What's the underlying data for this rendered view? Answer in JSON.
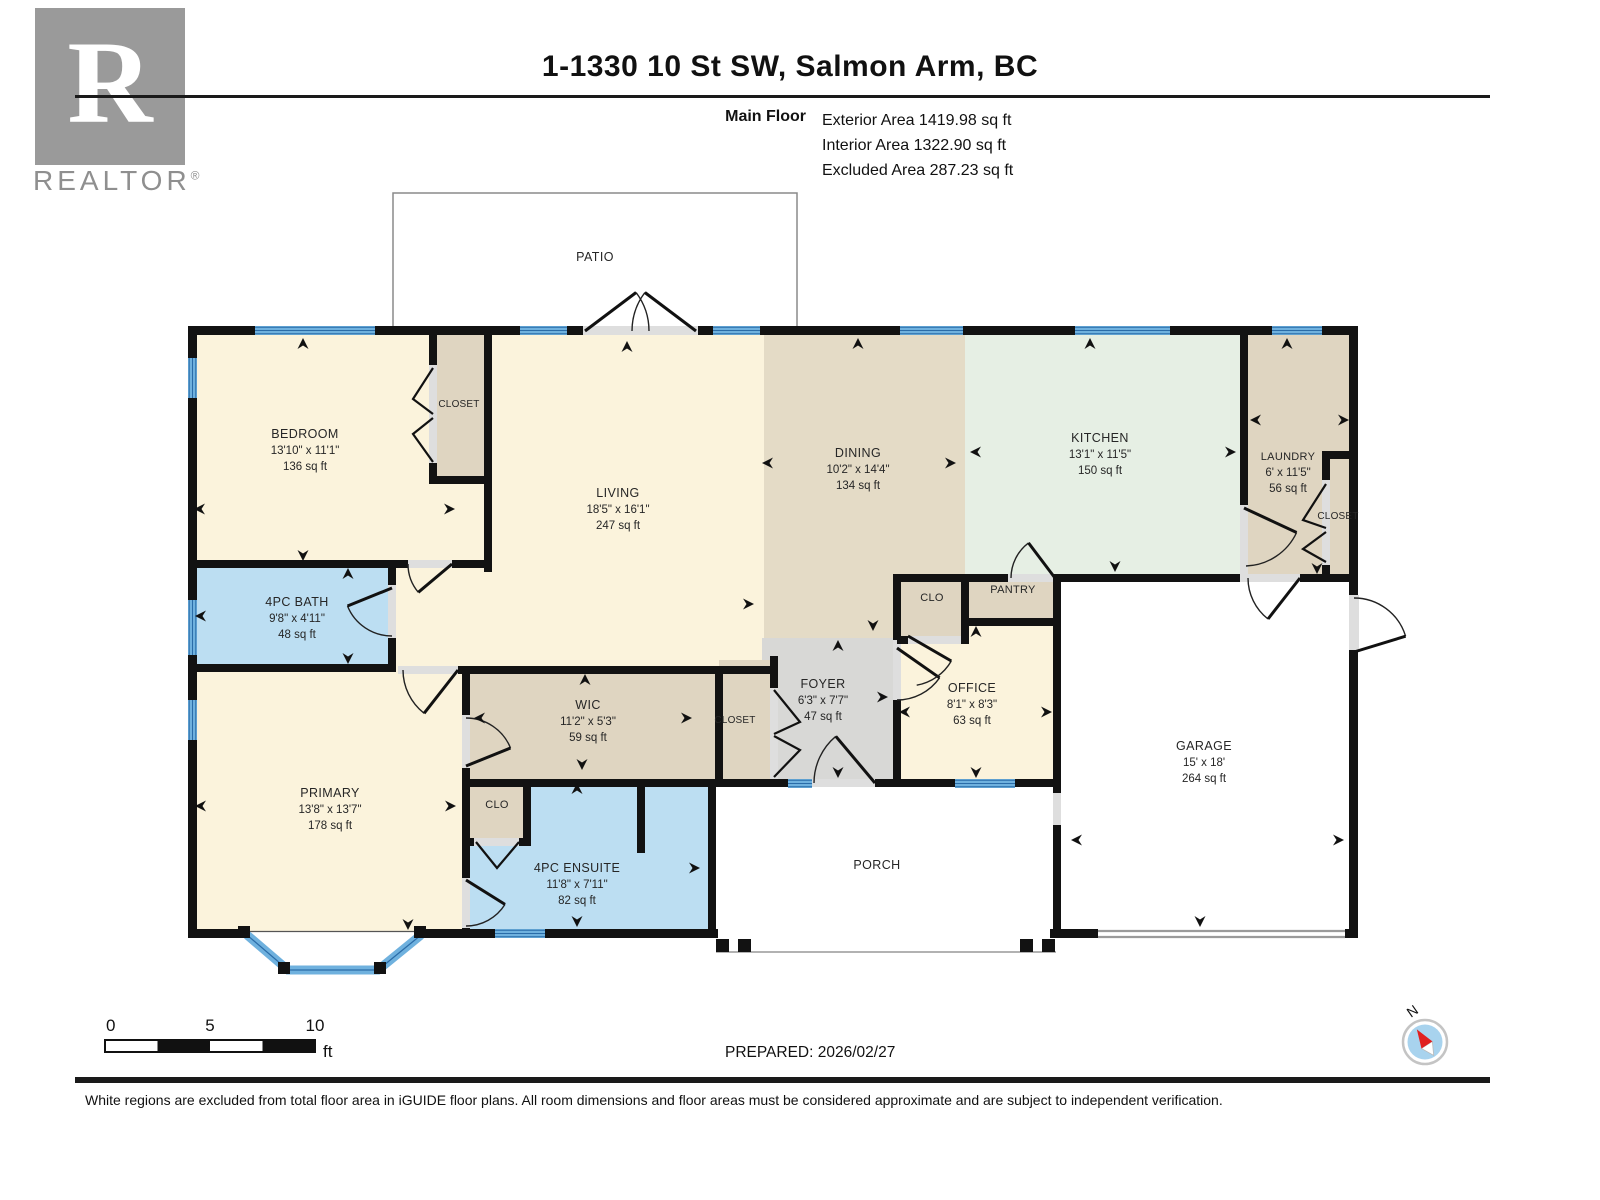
{
  "header": {
    "logo_letter": "R",
    "logo_text": "REALTOR",
    "logo_reg": "®",
    "title": "1-1330 10 St SW, Salmon Arm, BC",
    "floor_label": "Main Floor",
    "stats": [
      "Exterior Area 1419.98 sq ft",
      "Interior Area 1322.90 sq ft",
      "Excluded Area 287.23 sq ft"
    ]
  },
  "rooms": {
    "patio": {
      "name": "PATIO"
    },
    "bedroom": {
      "name": "BEDROOM",
      "dims": "13'10\" x 11'1\"",
      "area": "136 sq ft"
    },
    "closet_bedroom": {
      "name": "CLOSET"
    },
    "living": {
      "name": "LIVING",
      "dims": "18'5\" x 16'1\"",
      "area": "247 sq ft"
    },
    "dining": {
      "name": "DINING",
      "dims": "10'2\" x 14'4\"",
      "area": "134 sq ft"
    },
    "kitchen": {
      "name": "KITCHEN",
      "dims": "13'1\" x 11'5\"",
      "area": "150 sq ft"
    },
    "laundry": {
      "name": "LAUNDRY",
      "dims": "6' x 11'5\"",
      "area": "56 sq ft"
    },
    "closet_laundry": {
      "name": "CLOSET"
    },
    "bath": {
      "name": "4PC BATH",
      "dims": "9'8\" x 4'11\"",
      "area": "48 sq ft"
    },
    "primary": {
      "name": "PRIMARY",
      "dims": "13'8\" x 13'7\"",
      "area": "178 sq ft"
    },
    "wic": {
      "name": "WIC",
      "dims": "11'2\" x 5'3\"",
      "area": "59 sq ft"
    },
    "closet_hall": {
      "name": "CLOSET"
    },
    "foyer": {
      "name": "FOYER",
      "dims": "6'3\" x 7'7\"",
      "area": "47 sq ft"
    },
    "clo_office": {
      "name": "CLO"
    },
    "pantry": {
      "name": "PANTRY"
    },
    "office": {
      "name": "OFFICE",
      "dims": "8'1\" x 8'3\"",
      "area": "63 sq ft"
    },
    "garage": {
      "name": "GARAGE",
      "dims": "15' x 18'",
      "area": "264 sq ft"
    },
    "clo_primary": {
      "name": "CLO"
    },
    "ensuite": {
      "name": "4PC ENSUITE",
      "dims": "11'8\" x 7'11\"",
      "area": "82 sq ft"
    },
    "porch": {
      "name": "PORCH"
    }
  },
  "scale_bar": {
    "ticks": [
      "0",
      "5",
      "10"
    ],
    "unit": "ft"
  },
  "footer": {
    "prepared": "PREPARED: 2026/02/27",
    "compass_label": "N",
    "disclaimer": "White regions are excluded from total floor area in iGUIDE floor plans. All room dimensions and floor areas must be considered approximate and are subject to independent verification."
  },
  "colors": {
    "room_cream": "#FBF3DC",
    "room_tan": "#DFD5C1",
    "room_dining": "#E4DBC6",
    "room_kitchen": "#E6EFE4",
    "room_blue": "#BCDEF2",
    "room_gray": "#D8D8D6",
    "window_blue": "#6FB1DE",
    "window_line": "#2A6CA8",
    "door_gray": "#DEDEDE",
    "wall": "#121212"
  }
}
